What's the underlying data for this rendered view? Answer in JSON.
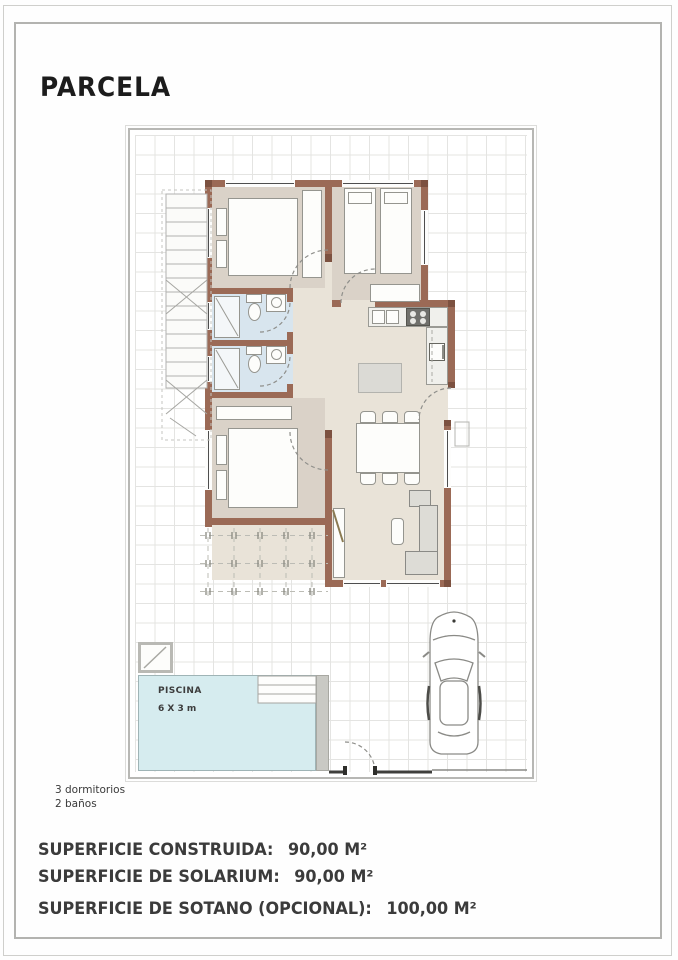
{
  "header": {
    "title": "PARCELA"
  },
  "plan": {
    "pool": {
      "label": "PISCINA",
      "size": "6 X 3 m"
    },
    "notes": [
      "3 dormitorios",
      "2 baños"
    ]
  },
  "surfaces": [
    {
      "label": "SUPERFICIE CONSTRUIDA:",
      "value": "90,00 M²"
    },
    {
      "label": "SUPERFICIE DE SOLARIUM:",
      "value": "90,00 M²"
    },
    {
      "label": "SUPERFICIE DE SOTANO (OPCIONAL):",
      "value": "100,00 M²"
    }
  ],
  "colors": {
    "wall": "#9b6a56",
    "bedroom_floor": "#dad2c8",
    "hall_floor": "#e9e3d8",
    "bath_floor": "#d8e5ee",
    "pool": "#d6ecef"
  }
}
